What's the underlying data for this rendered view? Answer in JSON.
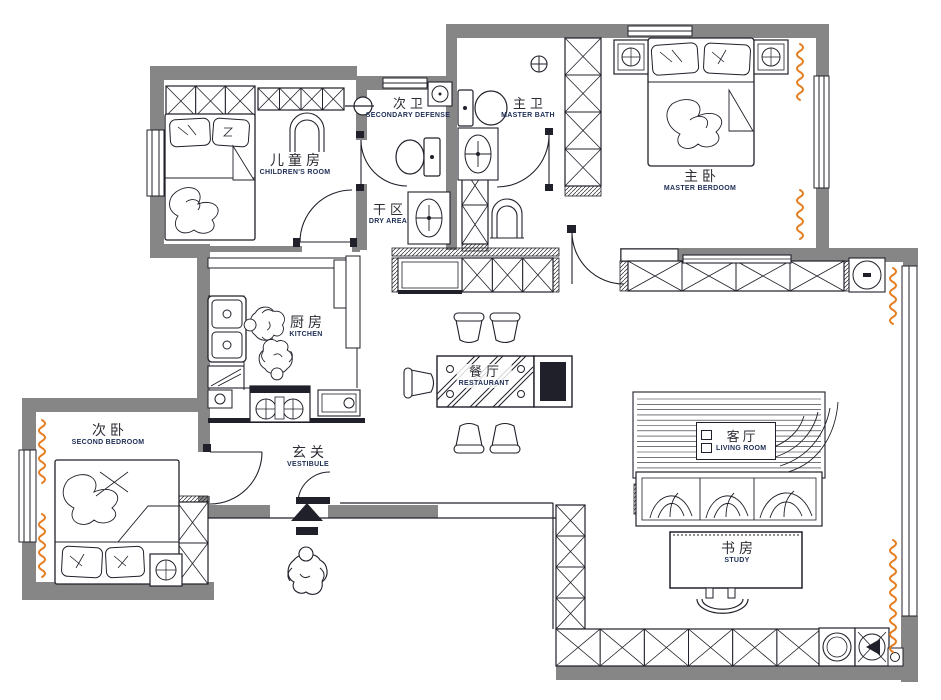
{
  "plan": {
    "title": "apartment-floor-plan",
    "colors": {
      "wall": "#868686",
      "line": "#20202a",
      "accent_orange": "#E67E22",
      "label_zh": "#2c2c34",
      "label_en": "#1e2d55"
    },
    "rooms": [
      {
        "id": "children",
        "zh": "儿童房",
        "en": "CHILDREN'S ROOM"
      },
      {
        "id": "sec_bath",
        "zh": "次卫",
        "en": "SECONDARY DEFENSE"
      },
      {
        "id": "master_bath",
        "zh": "主卫",
        "en": "MASTER BATH"
      },
      {
        "id": "master_bed",
        "zh": "主卧",
        "en": "MASTER BERDOOM"
      },
      {
        "id": "dry_area",
        "zh": "干区",
        "en": "DRY AREA"
      },
      {
        "id": "kitchen",
        "zh": "厨房",
        "en": "KITCHEN"
      },
      {
        "id": "dining",
        "zh": "餐厅",
        "en": "RESTAURANT"
      },
      {
        "id": "living",
        "zh": "客厅",
        "en": "LIVING ROOM"
      },
      {
        "id": "second_bed",
        "zh": "次卧",
        "en": "SECOND BEDROOM"
      },
      {
        "id": "vestibule",
        "zh": "玄关",
        "en": "VESTIBULE"
      },
      {
        "id": "study",
        "zh": "书房",
        "en": "STUDY"
      }
    ]
  }
}
